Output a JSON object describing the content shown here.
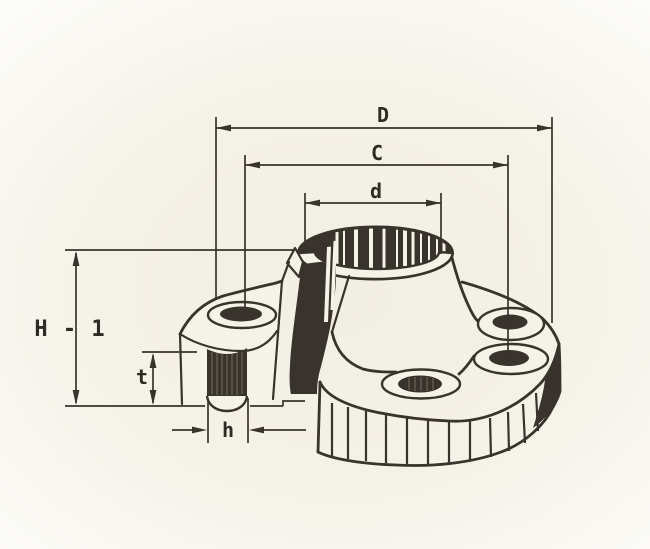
{
  "figure": {
    "type": "technical-drawing",
    "subject": "weld-neck flange isometric cutaway with dimension callouts",
    "colors": {
      "ink": "#38332c",
      "ink_text": "#2e2a24",
      "paper": "#f5f2e8",
      "bg_center": "#f1eee3",
      "bg_mid": "#f4f1e7",
      "bg_edge": "#fdfdfb"
    }
  },
  "labels": {
    "D": "D",
    "C": "C",
    "d": "d",
    "H1": "H - 1",
    "t": "t",
    "h": "h"
  }
}
